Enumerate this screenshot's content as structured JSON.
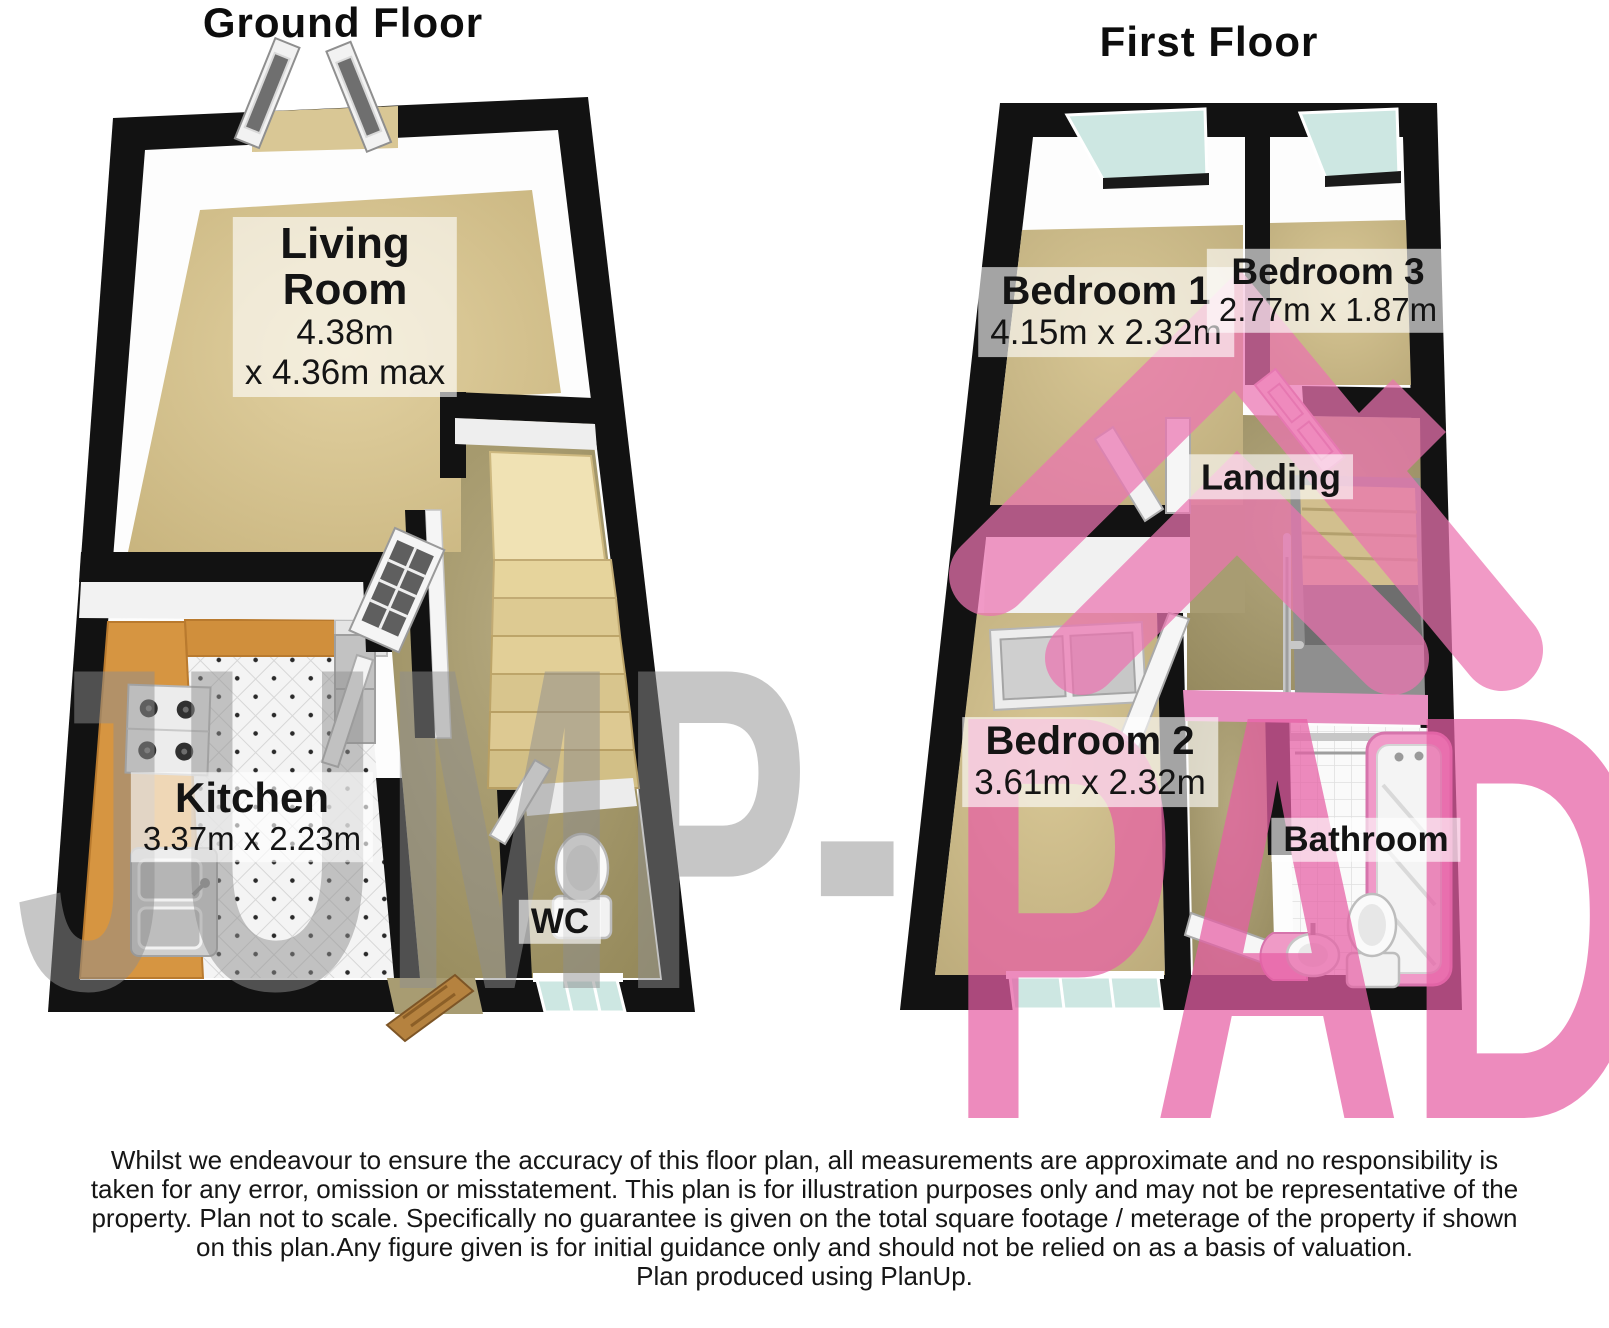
{
  "titles": {
    "ground": "Ground Floor",
    "first": "First Floor"
  },
  "rooms": {
    "living": {
      "name": "Living\nRoom",
      "dims_line1": "4.38m",
      "dims_line2": "x 4.36m max"
    },
    "kitchen": {
      "name": "Kitchen",
      "dims": "3.37m x 2.23m"
    },
    "wc": {
      "name": "WC"
    },
    "bedroom1": {
      "name": "Bedroom 1",
      "dims": "4.15m x 2.32m"
    },
    "bedroom3": {
      "name": "Bedroom 3",
      "dims": "2.77m x 1.87m"
    },
    "landing": {
      "name": "Landing"
    },
    "bedroom2": {
      "name": "Bedroom 2",
      "dims": "3.61m x 2.32m"
    },
    "bathroom": {
      "name": "Bathroom"
    }
  },
  "watermark": {
    "left_text": "JUMP-",
    "right_text": "PAD",
    "gray": "#8f8f8f",
    "pink": "#e75fa5"
  },
  "disclaimer": {
    "lines": [
      "Whilst we endeavour to ensure the accuracy of this floor plan, all measurements are approximate and no responsibility is",
      "taken for any error, omission or misstatement. This plan is for illustration purposes only and may not be representative of the",
      "property. Plan not to scale. Specifically no guarantee is given on the total square footage / meterage of the property if shown",
      "on this plan.Any figure given is for initial guidance only and should not be relied on as a basis of valuation.",
      "Plan produced using PlanUp."
    ]
  },
  "colors": {
    "wall": "#121212",
    "carpet_living": "#d7c493",
    "carpet_bedroom": "#cbba8a",
    "hall": "#a89c72",
    "counter": "#d69541",
    "stairs": "#e7d6a3",
    "glass": "#cde7e2",
    "bathroom_pink": "#ef97c5",
    "wood_door": "#b5823f"
  }
}
